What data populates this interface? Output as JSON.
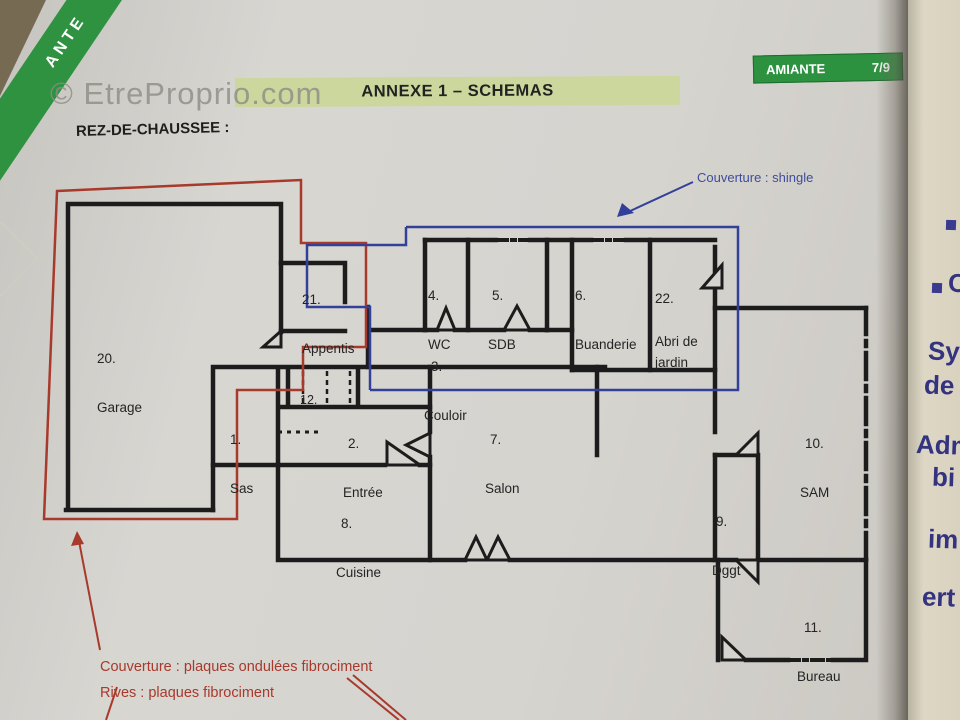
{
  "watermark": "© EtreProprio.com",
  "badge": {
    "label": "AMIANTE",
    "page": "7/9"
  },
  "corner_band": {
    "text": "ANTE"
  },
  "banner": {
    "title": "ANNEXE 1 – SCHEMAS"
  },
  "heading": "REZ-DE-CHAUSSEE :",
  "annotations": {
    "shingle": "Couverture : shingle",
    "roof_line1": "Couverture : plaques ondulées fibrociment",
    "roof_line2": "Rives : plaques fibrociment"
  },
  "rooms": [
    {
      "number": "20.",
      "name": "Garage"
    },
    {
      "number": "21.",
      "name": "Appentis"
    },
    {
      "number": "1.",
      "name": "Sas"
    },
    {
      "number": "12.",
      "name": ""
    },
    {
      "number": "2.",
      "name": "Entrée"
    },
    {
      "number": "3.",
      "name": "Couloir"
    },
    {
      "number": "4.",
      "name": "WC"
    },
    {
      "number": "5.",
      "name": "SDB"
    },
    {
      "number": "6.",
      "name": "Buanderie"
    },
    {
      "number": "22.",
      "name": "Abri de\njardin"
    },
    {
      "number": "7.",
      "name": "Salon"
    },
    {
      "number": "8.",
      "name": "Cuisine"
    },
    {
      "number": "9.",
      "name": "Dggt"
    },
    {
      "number": "10.",
      "name": "SAM"
    },
    {
      "number": "11.",
      "name": "Bureau"
    }
  ],
  "side_page_fragments": {
    "f1": "C",
    "f2": "Sy",
    "f3": "de",
    "f4": "Adm",
    "f5": "bi",
    "f6": "im",
    "f7": "ert"
  },
  "colors": {
    "roof_red": "#a83a2c",
    "roof_blue": "#32409a",
    "wall_black": "#1c1c1c",
    "banner_green": "#cbd79c",
    "badge_green": "#2c9240"
  }
}
